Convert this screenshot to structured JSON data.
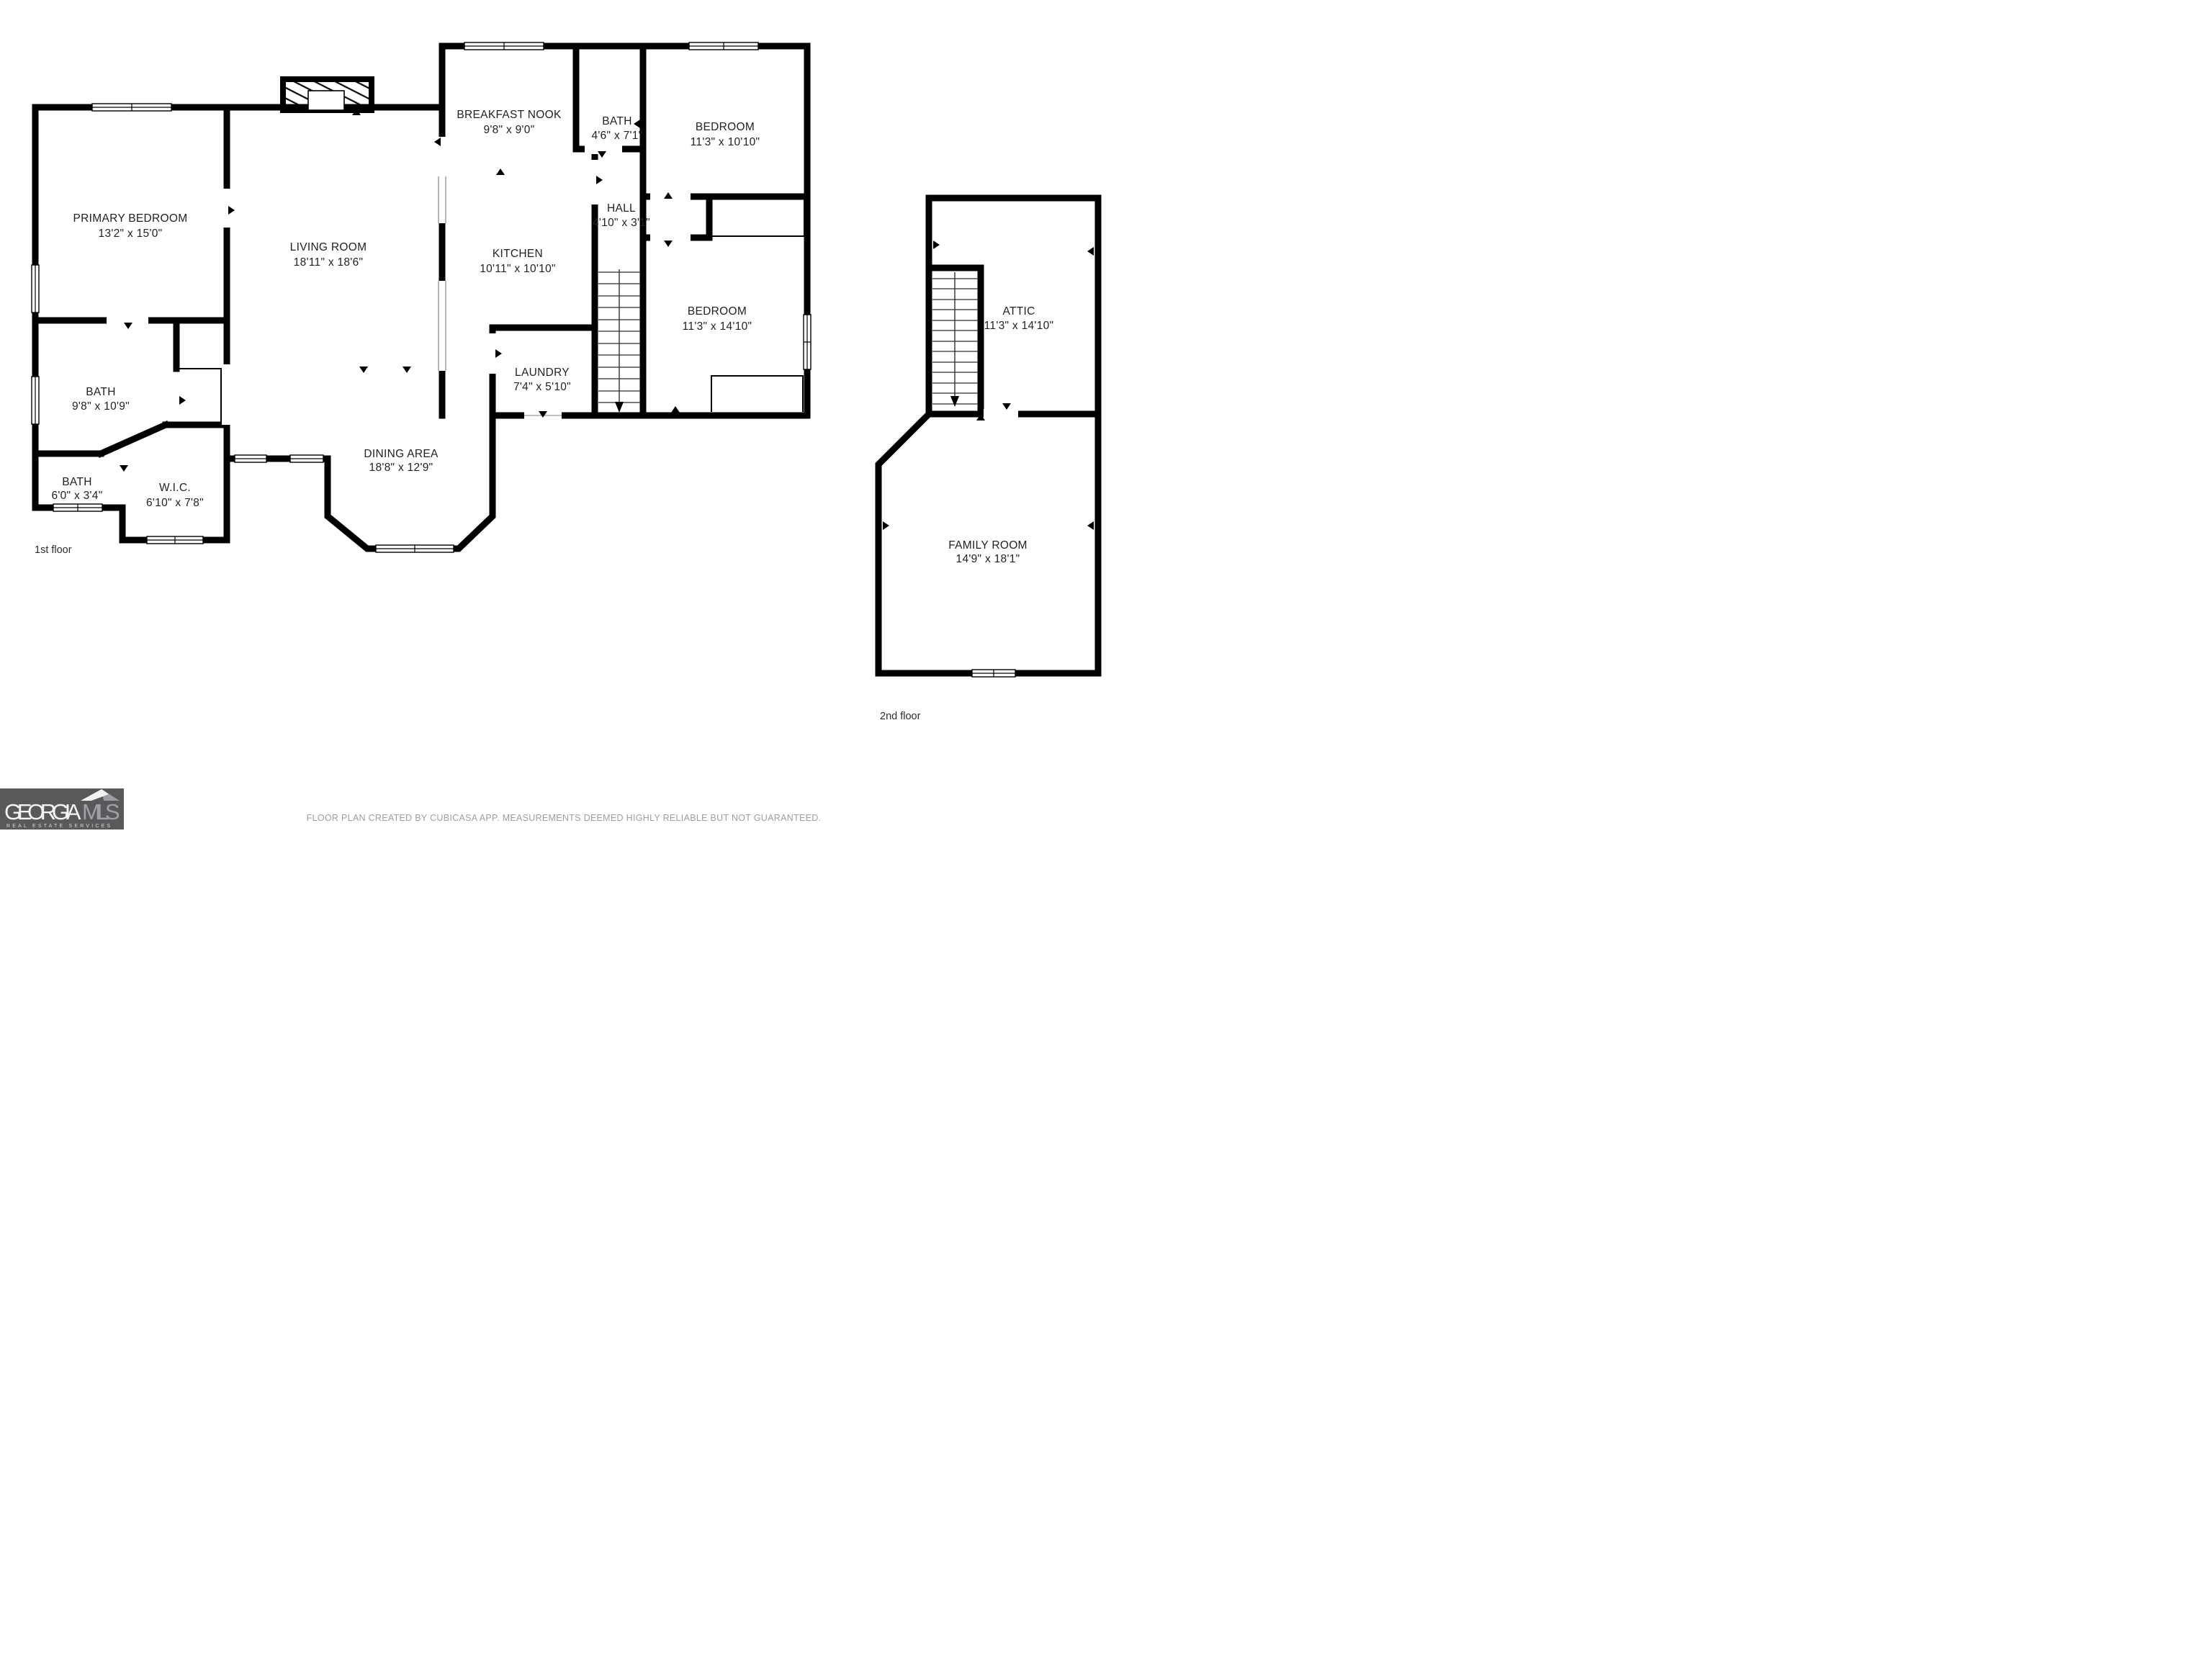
{
  "floors": {
    "first": {
      "label": "1st floor"
    },
    "second": {
      "label": "2nd floor"
    }
  },
  "rooms": {
    "primary_bedroom": {
      "name": "PRIMARY BEDROOM",
      "dims": "13'2\" x 15'0\""
    },
    "living_room": {
      "name": "LIVING ROOM",
      "dims": "18'11\" x 18'6\""
    },
    "breakfast_nook": {
      "name": "BREAKFAST NOOK",
      "dims": "9'8\" x 9'0\""
    },
    "bath_upper": {
      "name": "BATH",
      "dims": "4'6\" x 7'1\""
    },
    "bedroom_upper": {
      "name": "BEDROOM",
      "dims": "11'3\" x 10'10\""
    },
    "hall": {
      "name": "HALL",
      "dims": "4'10\" x 3'1\""
    },
    "kitchen": {
      "name": "KITCHEN",
      "dims": "10'11\" x 10'10\""
    },
    "bedroom_right": {
      "name": "BEDROOM",
      "dims": "11'3\" x 14'10\""
    },
    "laundry": {
      "name": "LAUNDRY",
      "dims": "7'4\" x 5'10\""
    },
    "bath_main": {
      "name": "BATH",
      "dims": "9'8\" x 10'9\""
    },
    "bath_small": {
      "name": "BATH",
      "dims": "6'0\" x 3'4\""
    },
    "wic": {
      "name": "W.I.C.",
      "dims": "6'10\" x 7'8\""
    },
    "dining_area": {
      "name": "DINING AREA",
      "dims": "18'8\" x 12'9\""
    },
    "attic": {
      "name": "ATTIC",
      "dims": "11'3\" x 14'10\""
    },
    "family_room": {
      "name": "FAMILY ROOM",
      "dims": "14'9\" x 18'1\""
    }
  },
  "footer": {
    "disclaimer": "FLOOR PLAN CREATED BY CUBICASA APP. MEASUREMENTS DEEMED HIGHLY RELIABLE BUT NOT GUARANTEED."
  },
  "logo": {
    "brand": "GEORGIA",
    "brand_suffix": "MLS",
    "tagline": "REAL ESTATE SERVICES"
  },
  "colors": {
    "wall": "#000000",
    "room_text": "#222222",
    "floor_label_text": "#2E2E2E",
    "footer_text": "#9E9E9E",
    "logo_bg": "#58595B"
  }
}
